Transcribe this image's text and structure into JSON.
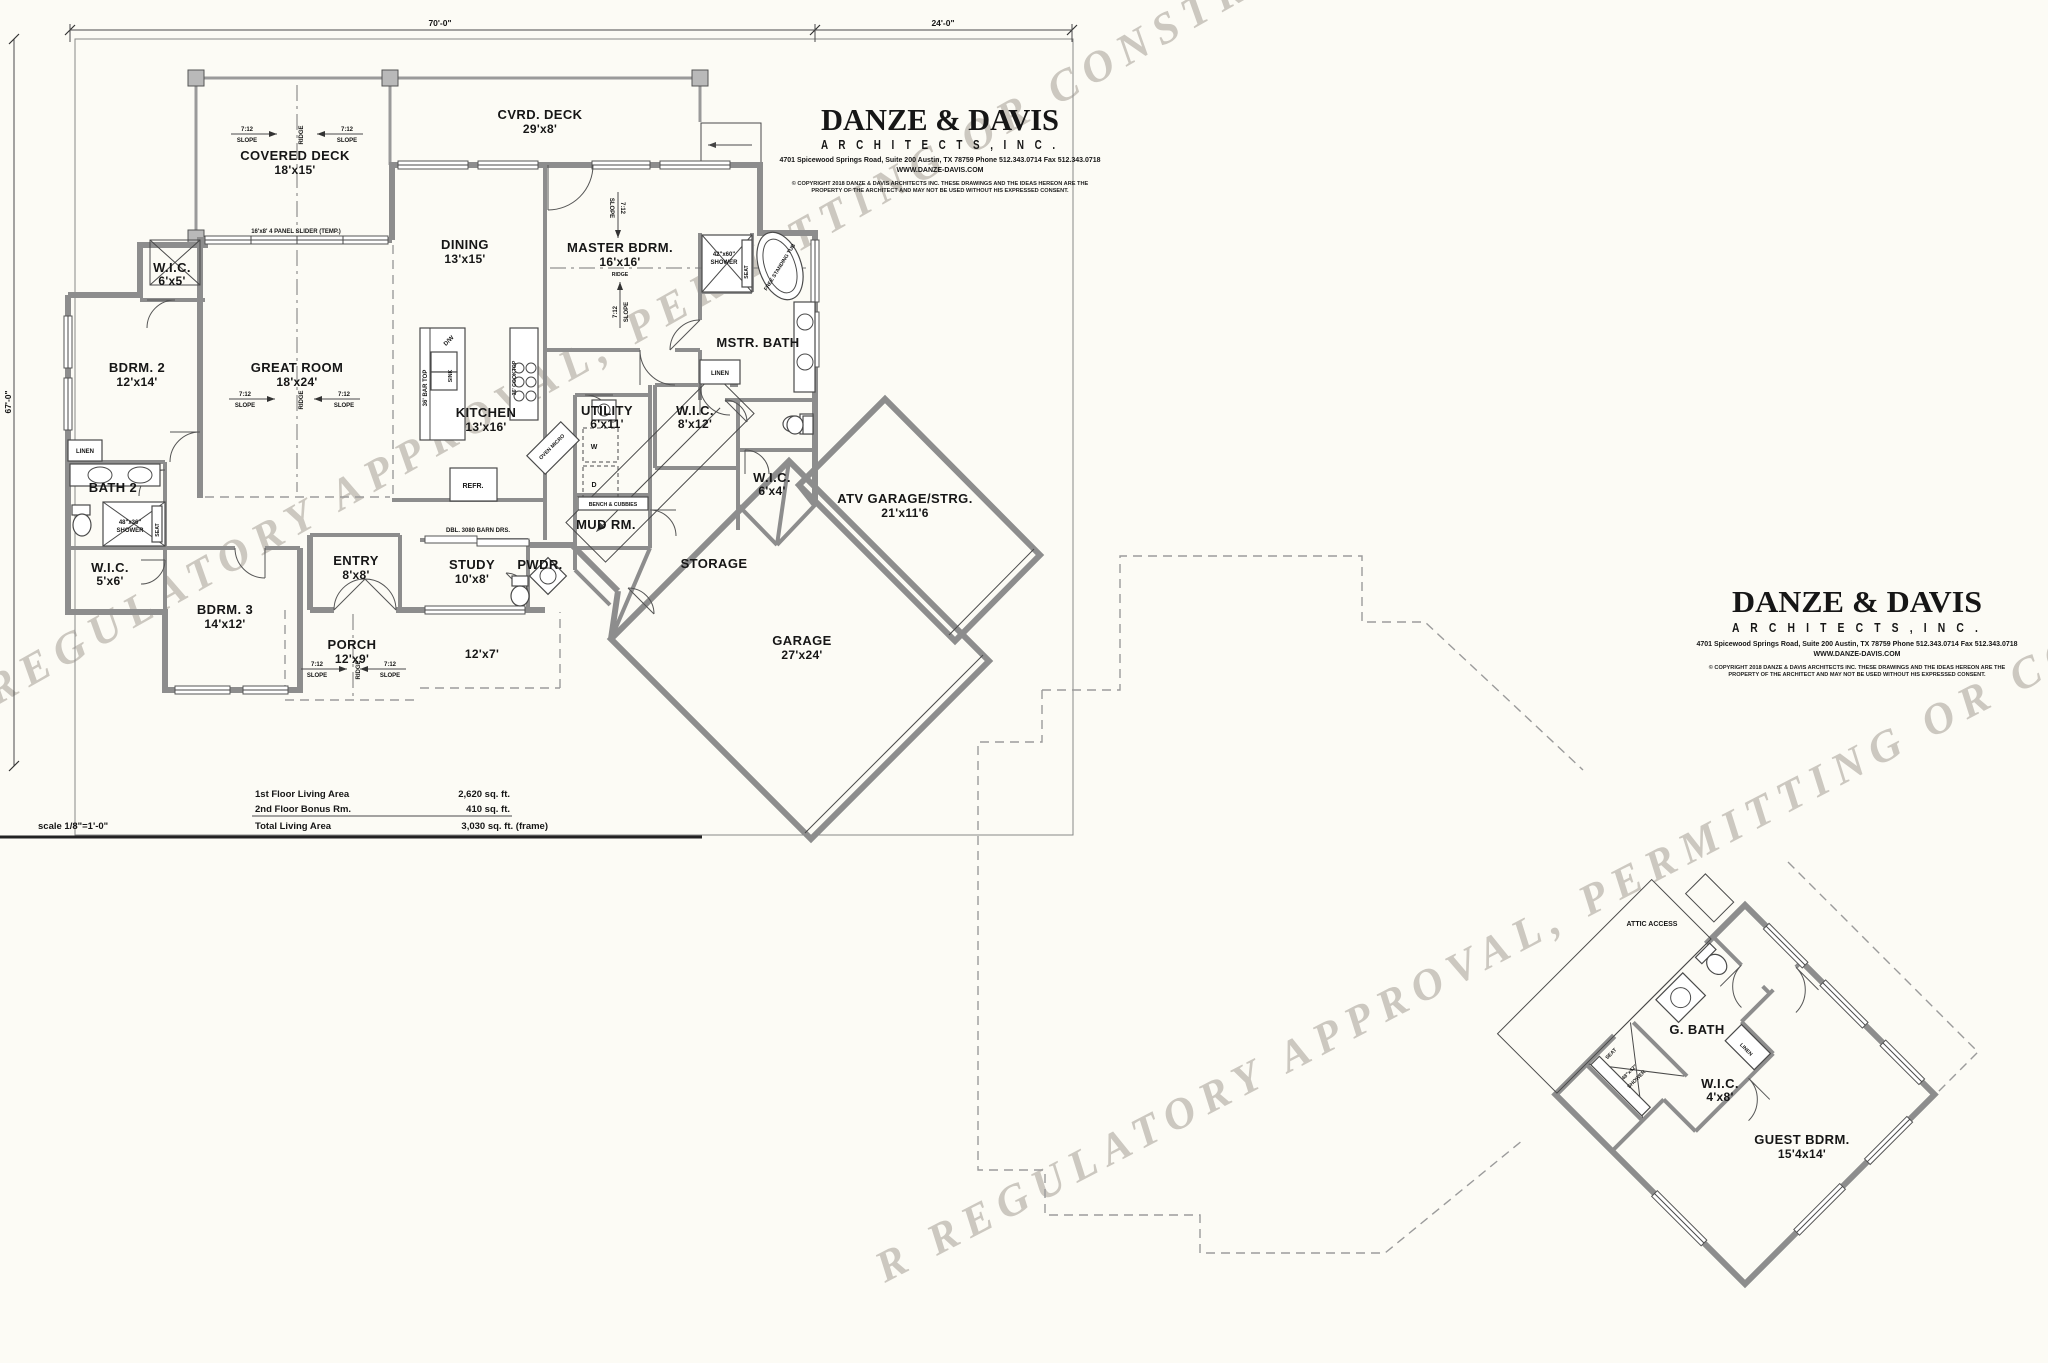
{
  "firm": {
    "name": "DANZE & DAVIS",
    "type": "A R C H I T E C T S ,  I N C .",
    "address": "4701 Spicewood Springs Road, Suite 200   Austin, TX 78759    Phone 512.343.0714   Fax 512.343.0718",
    "website": "WWW.DANZE-DAVIS.COM",
    "copyright1": "© COPYRIGHT 2018 DANZE & DAVIS ARCHITECTS INC.  THESE DRAWINGS AND THE IDEAS HEREON ARE THE",
    "copyright2": "PROPERTY OF THE ARCHITECT AND MAY NOT BE USED WITHOUT HIS EXPRESSED CONSENT."
  },
  "watermark": {
    "line1": "R REGULATORY APPROVAL, PERMITTING OR CONSTRUCTION  1",
    "line2": "R REGULATORY APPROVAL, PERMITTING OR CONSTRUCTION"
  },
  "dims": {
    "top_main": "70'-0\"",
    "top_right": "24'-0\"",
    "left": "67'-0\""
  },
  "scale_note": "scale 1/8\"=1'-0\"",
  "area_table": {
    "row1_label": "1st Floor Living Area",
    "row1_value": "2,620 sq. ft.",
    "row2_label": "2nd Floor Bonus Rm.",
    "row2_value": "410 sq. ft.",
    "row3_label": "Total Living Area",
    "row3_value": "3,030 sq. ft. (frame)"
  },
  "rooms": {
    "covered_deck": {
      "name": "COVERED DECK",
      "dim": "18'x15'"
    },
    "cvrd_deck": {
      "name": "CVRD. DECK",
      "dim": "29'x8'"
    },
    "dining": {
      "name": "DINING",
      "dim": "13'x15'"
    },
    "master": {
      "name": "MASTER BDRM.",
      "dim": "16'x16'"
    },
    "great_room": {
      "name": "GREAT ROOM",
      "dim": "18'x24'"
    },
    "kitchen": {
      "name": "KITCHEN",
      "dim": "13'x16'"
    },
    "wic_bdrm2": {
      "name": "W.I.C.",
      "dim": "6'x5'"
    },
    "bdrm2": {
      "name": "BDRM. 2",
      "dim": "12'x14'"
    },
    "bath2": {
      "name": "BATH 2"
    },
    "wic_bdrm3": {
      "name": "W.I.C.",
      "dim": "5'x6'"
    },
    "bdrm3": {
      "name": "BDRM. 3",
      "dim": "14'x12'"
    },
    "entry": {
      "name": "ENTRY",
      "dim": "8'x8'"
    },
    "study": {
      "name": "STUDY",
      "dim": "10'x8'"
    },
    "pwdr": {
      "name": "PWDR."
    },
    "utility": {
      "name": "UTILITY",
      "dim": "6'x11'"
    },
    "wic_master": {
      "name": "W.I.C.",
      "dim": "8'x12'"
    },
    "mstr_bath": {
      "name": "MSTR. BATH"
    },
    "wic_hall": {
      "name": "W.I.C.",
      "dim": "6'x4'"
    },
    "mud": {
      "name": "MUD RM."
    },
    "storage": {
      "name": "STORAGE"
    },
    "garage": {
      "name": "GARAGE",
      "dim": "27'x24'"
    },
    "atv": {
      "name": "ATV GARAGE/STRG.",
      "dim": "21'x11'6"
    },
    "porch": {
      "name": "PORCH",
      "dim": "12'x9'"
    },
    "porch2": {
      "dim": "12'x7'"
    },
    "guest": {
      "name": "GUEST BDRM.",
      "dim": "15'4x14'"
    },
    "gbath": {
      "name": "G. BATH"
    },
    "wic_guest": {
      "name": "W.I.C.",
      "dim": "4'x8'"
    }
  },
  "annot": {
    "slope_ratio": "7:12",
    "slope_word": "SLOPE",
    "ridge": "RIDGE",
    "slider": "16'x8' 4 PANEL SLIDER (TEMP.)",
    "barn_doors": "DBL. 3080 BARN DRS.",
    "linen": "LINEN",
    "seat": "SEAT",
    "shower_word": "SHOWER",
    "shower_master": "42\"x60\"",
    "shower_bath2": "48\"x36\"",
    "shower_guest": "48\"x42\"",
    "tub": "FREE STANDING TUB",
    "bench": "BENCH & CUBBIES",
    "refr": "REFR.",
    "bar_top": "36' BAR TOP",
    "cooktop": "36' COOKTOP",
    "dw": "D/W",
    "sink": "SINK",
    "oven": "OVEN MICRO",
    "washer": "W",
    "dryer": "D",
    "attic": "ATTIC ACCESS"
  }
}
